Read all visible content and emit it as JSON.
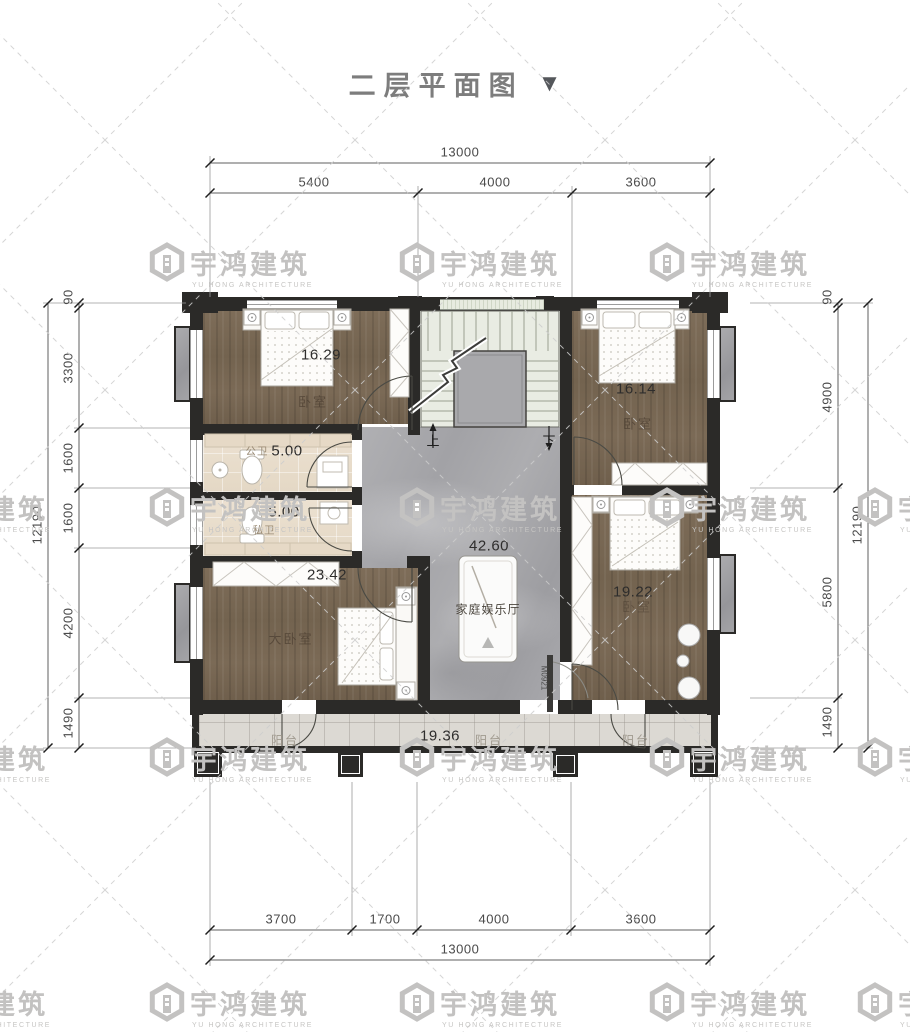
{
  "title": {
    "text": "二层平面图",
    "triangle": "▼"
  },
  "watermark": {
    "name_cn": "宇鸿建筑",
    "name_en": "YU HONG ARCHITECTURE"
  },
  "dimensions": {
    "top": {
      "total": "13000",
      "segments": [
        "5400",
        "4000",
        "3600"
      ]
    },
    "bottom": {
      "total": "13000",
      "segments": [
        "3700",
        "1700",
        "4000",
        "3600"
      ]
    },
    "left": {
      "total": "12190",
      "segments": [
        "90",
        "3300",
        "1600",
        "1600",
        "4200",
        "1490"
      ]
    },
    "right": {
      "total": "12190",
      "segments": [
        "90",
        "4900",
        "5800",
        "1490"
      ]
    }
  },
  "rooms": {
    "bedroom_top_left": {
      "label": "卧室",
      "area": "16.29"
    },
    "bedroom_top_right": {
      "label": "卧室",
      "area": "16.14"
    },
    "public_bath": {
      "label": "公卫",
      "area": "5.00"
    },
    "private_bath": {
      "label": "私卫",
      "area": "5.00"
    },
    "master_bedroom": {
      "label": "大卧室",
      "area": "23.42"
    },
    "family_room": {
      "label": "家庭娱乐厅",
      "area": "42.60"
    },
    "bedroom_bottom_right": {
      "label": "卧室",
      "area": "19.22"
    },
    "balcony": {
      "label": "阳台",
      "area": "19.36"
    }
  },
  "stairs": {
    "up_label": "上",
    "down_label": "下"
  },
  "door_code": "M0921",
  "colors": {
    "wall": "#2b2a28",
    "wood_floor": "#7a6955",
    "marble_floor": "#a9a9ac",
    "bath_floor": "#e9decd",
    "balcony_floor": "#dcd9d3",
    "stair_floor": "#e9ece3",
    "dimension_text": "#4a4a4a",
    "watermark": "#c3c2c1",
    "title_text": "#7d7d7d"
  }
}
